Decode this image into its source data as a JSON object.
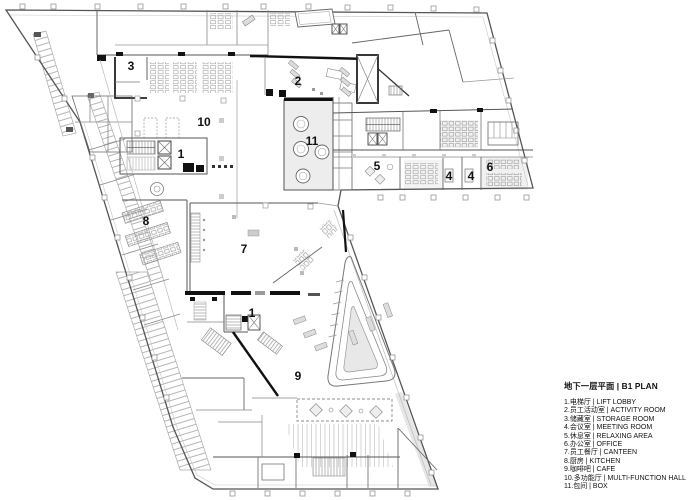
{
  "legend": {
    "title": "地下一层平面 | B1 PLAN",
    "items": [
      "1.电梯厅 | LIFT LOBBY",
      "2.员工活动室 | ACTIVITY ROOM",
      "3.储藏室 | STORAGE ROOM",
      "4.会议室 | MEETING ROOM",
      "5.休息室 | RELAXING AREA",
      "6.办公室 | OFFICE",
      "7.员工餐厅 | CANTEEN",
      "8.厨房 | KITCHEN",
      "9.咖啡吧 | CAFE",
      "10.多功能厅 | MULTI-FUNCTION HALL",
      "11.包间 | BOX"
    ]
  },
  "plan": {
    "room_labels": [
      {
        "n": "3",
        "x": 131,
        "y": 66
      },
      {
        "n": "2",
        "x": 298,
        "y": 81
      },
      {
        "n": "10",
        "x": 204,
        "y": 122
      },
      {
        "n": "11",
        "x": 312,
        "y": 141
      },
      {
        "n": "1",
        "x": 181,
        "y": 154
      },
      {
        "n": "5",
        "x": 377,
        "y": 166
      },
      {
        "n": "4",
        "x": 449,
        "y": 176
      },
      {
        "n": "4",
        "x": 471,
        "y": 176
      },
      {
        "n": "6",
        "x": 490,
        "y": 167
      },
      {
        "n": "8",
        "x": 146,
        "y": 221
      },
      {
        "n": "7",
        "x": 244,
        "y": 249
      },
      {
        "n": "1",
        "x": 252,
        "y": 313
      },
      {
        "n": "9",
        "x": 298,
        "y": 376
      }
    ],
    "colors": {
      "background": "#ffffff",
      "outline": "#555555",
      "wall": "#111111",
      "hatch": "#d8d8d8",
      "text": "#111111"
    }
  }
}
